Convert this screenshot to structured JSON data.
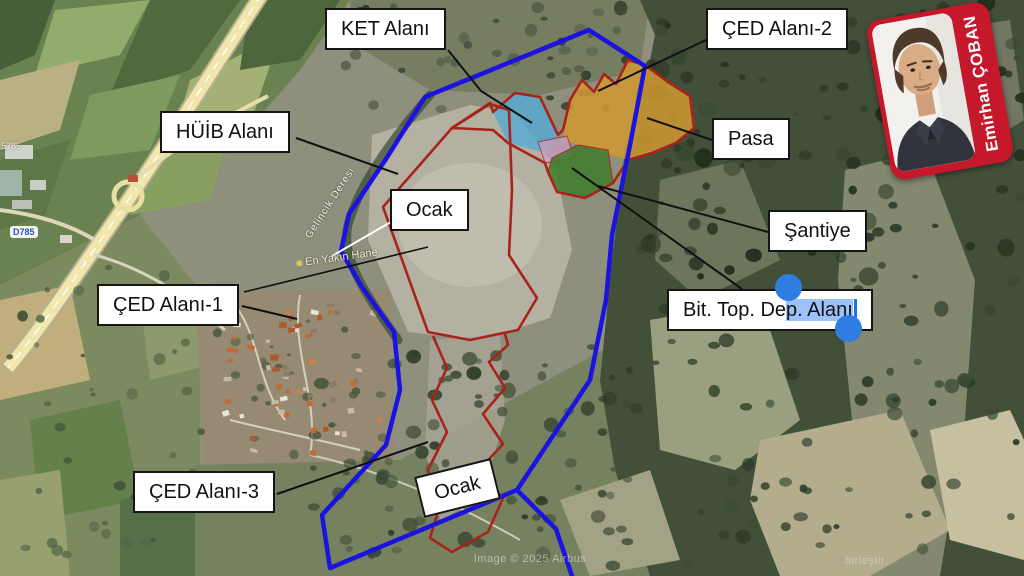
{
  "labels": {
    "ket": "KET Alanı",
    "ced2": "ÇED Alanı-2",
    "huib": "HÜİB Alanı",
    "pasa": "Pasa",
    "ocak_upper": "Ocak",
    "santiye": "Şantiye",
    "ced1": "ÇED Alanı-1",
    "ced3": "ÇED Alanı-3",
    "ocak_lower": "Ocak",
    "bit_top_prefix": "Bit. Top. De",
    "bit_top_selected": "p. Alanı",
    "bit_top_full": "Bit. Top. Dep. Alanı"
  },
  "badge": {
    "name": "Emirhan ÇOBAN"
  },
  "map_texts": {
    "creek": "Gelincik Deresi",
    "nearest_house": "En Yakın Hane",
    "road_shield": "D785",
    "road_label": "5785",
    "watermark_center": "Image © 2025 Airbus",
    "watermark_right": "birleştir"
  },
  "colors": {
    "boundary_blue": "#1b13e0",
    "outline_red": "#a8241a",
    "fill_cyan": "#55abd6",
    "fill_orange": "#d09933",
    "fill_green": "#3f7d2b",
    "fill_pink": "#c9a0c8",
    "selection_blue": "#9cc3f7",
    "handle_blue": "#2f7de1",
    "badge_red": "#c5182b"
  }
}
